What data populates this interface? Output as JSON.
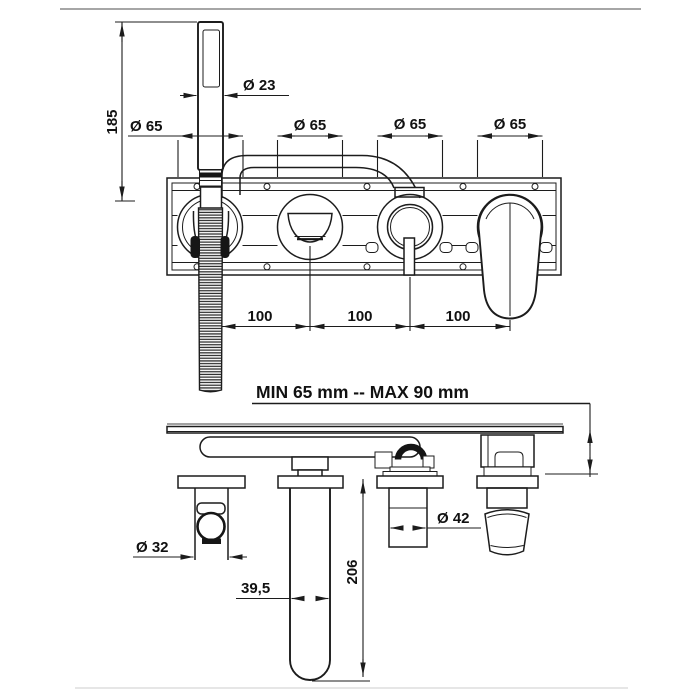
{
  "drawing": {
    "front_view": {
      "dim_height": "185",
      "dim_handshower": "Ø 23",
      "dim_escutcheons": [
        "Ø 65",
        "Ø 65",
        "Ø 65",
        "Ø 65"
      ],
      "dim_spacings": [
        "100",
        "100",
        "100"
      ]
    },
    "note_depth": "MIN 65 mm -- MAX 90 mm",
    "bottom_view": {
      "dim_holder": "Ø 32",
      "dim_cartridge": "Ø 42",
      "dim_spout_width": "39,5",
      "dim_spout_length": "206"
    },
    "colors": {
      "line": "#1c1c1c",
      "rule_top": "#a6a6a6",
      "rule_bottom": "#dddddd",
      "background": "#ffffff"
    }
  }
}
